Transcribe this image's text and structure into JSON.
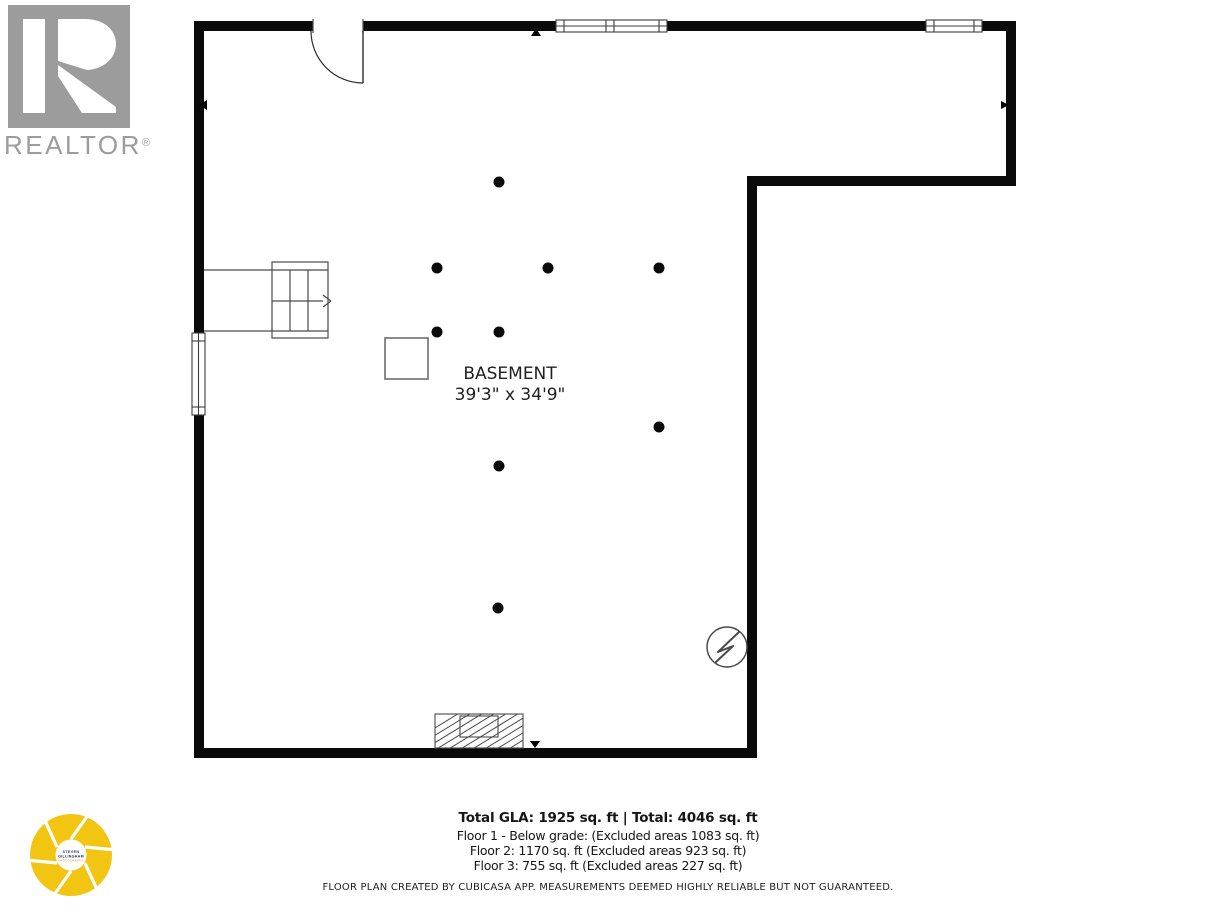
{
  "branding": {
    "realtor": {
      "wordmark": "REALTOR",
      "registered": "®"
    },
    "photographer": {
      "line1": "STEVEN",
      "line2": "GILLINGHAM",
      "line3": "PHOTOGRAPHY"
    }
  },
  "plan": {
    "room_label": "BASEMENT",
    "room_dimensions": "39'3\" x 34'9\""
  },
  "summary": {
    "total_line": "Total GLA: 1925 sq. ft | Total: 4046 sq. ft",
    "floor1_line": "Floor 1 - Below grade: (Excluded areas 1083 sq. ft)",
    "floor2_line": "Floor 2: 1170 sq. ft (Excluded areas 923 sq. ft)",
    "floor3_line": "Floor 3: 755 sq. ft (Excluded areas 227 sq. ft)"
  },
  "disclaimer": "FLOOR PLAN CREATED BY CUBICASA APP. MEASUREMENTS DEEMED HIGHLY RELIABLE BUT NOT GUARANTEED.",
  "colors": {
    "wall": "#0a0a0a",
    "thin_line": "#4a4a4a",
    "logo_gray": "#9c9c9c",
    "aperture_yellow": "#f3c513"
  }
}
